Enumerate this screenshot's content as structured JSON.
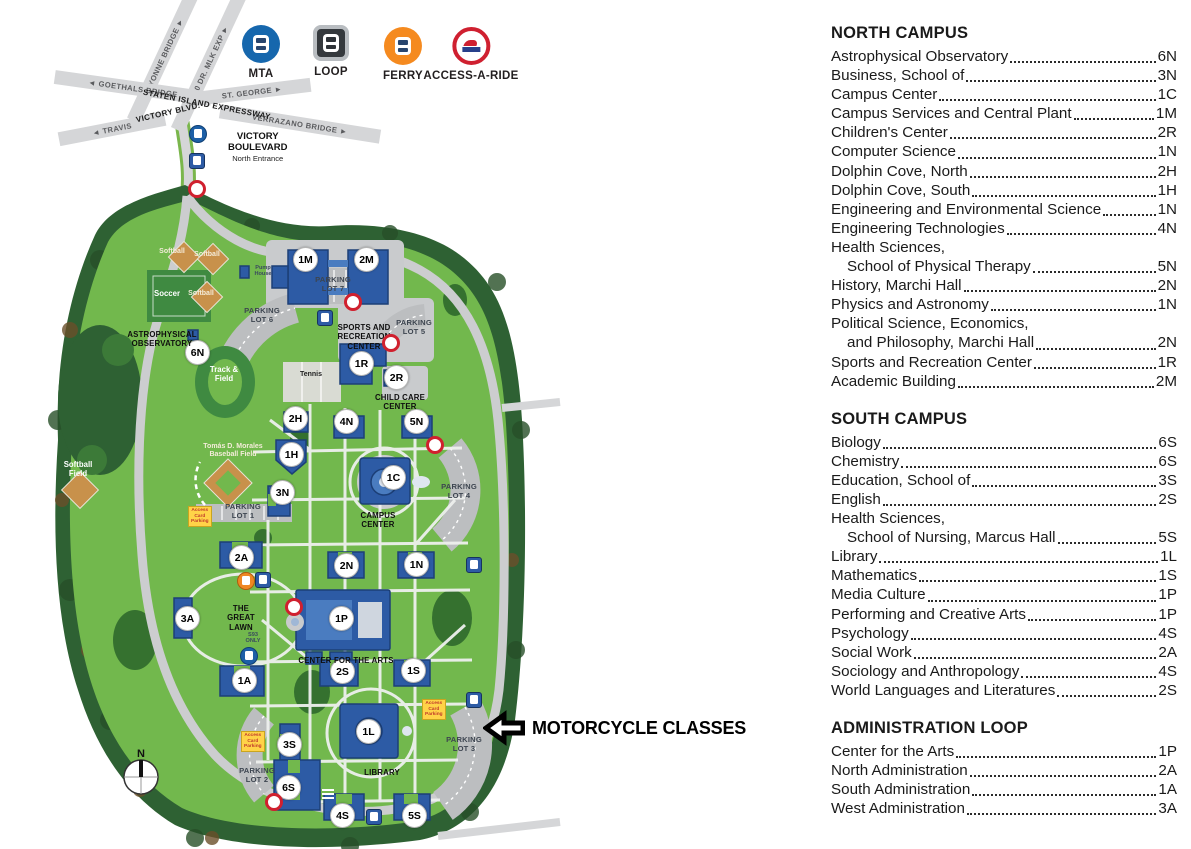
{
  "colors": {
    "campus_green": "#72b84d",
    "field_green": "#3f8a41",
    "tree_green": "#2e6133",
    "road_gray": "#d5d6d8",
    "parking_gray": "#bcbec0",
    "building_blue": "#2d5ba5",
    "building_outline": "#1c3f77",
    "marker_red": "#d0202e",
    "sign_yellow": "#ffd348",
    "mta_blue": "#1667ad",
    "loop_dark": "#35393d",
    "ferry_orange": "#f58a1f",
    "aar_red": "#cf2030"
  },
  "transit_legend": {
    "items": [
      {
        "name": "MTA",
        "type": "mta",
        "x": 261,
        "y": 25
      },
      {
        "name": "LOOP",
        "type": "loop",
        "x": 331,
        "y": 25
      },
      {
        "name": "FERRY",
        "type": "ferry",
        "x": 403,
        "y": 27
      },
      {
        "name": "ACCESS-A-RIDE",
        "type": "aar",
        "x": 471,
        "y": 27
      }
    ]
  },
  "roads": [
    {
      "label": "BAYONNE BRIDGE ►",
      "x": 163,
      "y": 57,
      "w": 140,
      "rot": -65,
      "bold": false
    },
    {
      "label": "440   DR. MLK EXP ►",
      "x": 209,
      "y": 62,
      "w": 150,
      "rot": -65,
      "bold": false
    },
    {
      "label": "◄ GOETHALS BRIDGE",
      "x": 133,
      "y": 88,
      "w": 158,
      "rot": 8,
      "bold": false
    },
    {
      "label": "ST. GEORGE ►",
      "x": 252,
      "y": 92,
      "w": 118,
      "rot": -7,
      "bold": false
    },
    {
      "label": "◄ TRAVIS",
      "x": 112,
      "y": 129,
      "w": 108,
      "rot": -11,
      "bold": false
    },
    {
      "label": "VERRAZANO BRIDGE ►",
      "x": 300,
      "y": 124,
      "w": 162,
      "rot": 9,
      "bold": false
    },
    {
      "label": "STATEN ISLAND EXPRESSWAY",
      "x": 207,
      "y": 104,
      "w": 178,
      "rot": 11,
      "bold": true
    },
    {
      "label": "VICTORY BLVD.",
      "x": 168,
      "y": 112,
      "w": 106,
      "rot": -13,
      "bold": true
    }
  ],
  "entrance": {
    "line1": "VICTORY",
    "line2": "BOULEVARD",
    "line3": "North Entrance"
  },
  "map": {
    "markers": [
      {
        "code": "6N",
        "x": 197,
        "y": 352
      },
      {
        "code": "1M",
        "x": 305,
        "y": 259
      },
      {
        "code": "2M",
        "x": 366,
        "y": 259
      },
      {
        "code": "1R",
        "x": 361,
        "y": 363
      },
      {
        "code": "2R",
        "x": 396,
        "y": 377
      },
      {
        "code": "2H",
        "x": 295,
        "y": 418
      },
      {
        "code": "4N",
        "x": 346,
        "y": 421
      },
      {
        "code": "5N",
        "x": 416,
        "y": 421
      },
      {
        "code": "1H",
        "x": 291,
        "y": 454
      },
      {
        "code": "3N",
        "x": 282,
        "y": 492
      },
      {
        "code": "1C",
        "x": 393,
        "y": 477
      },
      {
        "code": "2A",
        "x": 241,
        "y": 557
      },
      {
        "code": "2N",
        "x": 346,
        "y": 565
      },
      {
        "code": "1N",
        "x": 416,
        "y": 564
      },
      {
        "code": "3A",
        "x": 187,
        "y": 618
      },
      {
        "code": "1P",
        "x": 341,
        "y": 618
      },
      {
        "code": "1A",
        "x": 244,
        "y": 680
      },
      {
        "code": "2S",
        "x": 342,
        "y": 671
      },
      {
        "code": "1S",
        "x": 413,
        "y": 670
      },
      {
        "code": "3S",
        "x": 289,
        "y": 744
      },
      {
        "code": "6S",
        "x": 288,
        "y": 787
      },
      {
        "code": "1L",
        "x": 368,
        "y": 731
      },
      {
        "code": "4S",
        "x": 342,
        "y": 815
      },
      {
        "code": "5S",
        "x": 414,
        "y": 815
      }
    ],
    "labels": [
      {
        "text": "ASTROPHYSICAL\nOBSERVATORY",
        "x": 162,
        "y": 330,
        "cls": "lb-building"
      },
      {
        "text": "PARKING\nLOT 7",
        "x": 333,
        "y": 276,
        "cls": "lb-parking"
      },
      {
        "text": "PARKING\nLOT 6",
        "x": 262,
        "y": 307,
        "cls": "lb-parking"
      },
      {
        "text": "PARKING\nLOT 5",
        "x": 414,
        "y": 319,
        "cls": "lb-parking"
      },
      {
        "text": "PARKING\nLOT 4",
        "x": 459,
        "y": 483,
        "cls": "lb-parking"
      },
      {
        "text": "PARKING\nLOT 1",
        "x": 243,
        "y": 503,
        "cls": "lb-parking"
      },
      {
        "text": "PARKING\nLOT 2",
        "x": 257,
        "y": 767,
        "cls": "lb-parking"
      },
      {
        "text": "PARKING\nLOT 3",
        "x": 464,
        "y": 736,
        "cls": "lb-parking"
      },
      {
        "text": "SPORTS AND\nRECREATION\nCENTER",
        "x": 364,
        "y": 323,
        "cls": "lb-building"
      },
      {
        "text": "CHILD CARE\nCENTER",
        "x": 400,
        "y": 393,
        "cls": "lb-building"
      },
      {
        "text": "CAMPUS\nCENTER",
        "x": 378,
        "y": 511,
        "cls": "lb-building"
      },
      {
        "text": "CENTER FOR THE ARTS",
        "x": 346,
        "y": 656,
        "cls": "lb-building"
      },
      {
        "text": "LIBRARY",
        "x": 382,
        "y": 768,
        "cls": "lb-building"
      },
      {
        "text": "THE\nGREAT\nLAWN",
        "x": 241,
        "y": 604,
        "cls": "lb-building"
      },
      {
        "text": "Track &\nField",
        "x": 224,
        "y": 366,
        "cls": "lb-field"
      },
      {
        "text": "Tennis",
        "x": 311,
        "y": 371,
        "cls": "lb-dark-sm"
      },
      {
        "text": "Soccer",
        "x": 167,
        "y": 290,
        "cls": "lb-field"
      },
      {
        "text": "Softball",
        "x": 172,
        "y": 248,
        "cls": "lb-field-sm"
      },
      {
        "text": "Softball",
        "x": 207,
        "y": 251,
        "cls": "lb-field-sm"
      },
      {
        "text": "Softball",
        "x": 201,
        "y": 290,
        "cls": "lb-field-sm"
      },
      {
        "text": "Tomás D. Morales\nBaseball Field",
        "x": 233,
        "y": 443,
        "cls": "lb-field-sm"
      },
      {
        "text": "Softball\nField",
        "x": 78,
        "y": 461,
        "cls": "lb-field"
      },
      {
        "text": "Pump\nHouse",
        "x": 263,
        "y": 265,
        "cls": "lb-tiny"
      },
      {
        "text": "S93\nONLY",
        "x": 253,
        "y": 632,
        "cls": "lb-tiny"
      }
    ],
    "stops": [
      {
        "x": 197,
        "y": 189
      },
      {
        "x": 353,
        "y": 302
      },
      {
        "x": 391,
        "y": 343
      },
      {
        "x": 435,
        "y": 445
      },
      {
        "x": 294,
        "y": 607
      },
      {
        "x": 274,
        "y": 802
      }
    ],
    "buses": [
      {
        "type": "ci",
        "x": 197,
        "y": 133
      },
      {
        "type": "sq",
        "x": 197,
        "y": 161
      },
      {
        "type": "sq",
        "x": 325,
        "y": 318
      },
      {
        "type": "ci orange",
        "x": 245,
        "y": 580
      },
      {
        "type": "sq",
        "x": 263,
        "y": 580
      },
      {
        "type": "ci",
        "x": 248,
        "y": 655
      },
      {
        "type": "sq",
        "x": 474,
        "y": 565
      },
      {
        "type": "sq",
        "x": 474,
        "y": 700
      },
      {
        "type": "sq",
        "x": 374,
        "y": 817
      }
    ],
    "signs": [
      {
        "text": "Access\nCard\nParking",
        "x": 201,
        "y": 517
      },
      {
        "text": "Access\nCard\nParking",
        "x": 254,
        "y": 742
      },
      {
        "text": "Access\nCard\nParking",
        "x": 435,
        "y": 710
      }
    ]
  },
  "annotation": {
    "text": "MOTORCYCLE CLASSES"
  },
  "compass": {
    "label": "N"
  },
  "legend_sections": [
    {
      "title": "NORTH CAMPUS",
      "entries": [
        {
          "name": "Astrophysical Observatory",
          "code": "6N"
        },
        {
          "name": "Business, School of",
          "code": "3N"
        },
        {
          "name": "Campus Center",
          "code": "1C"
        },
        {
          "name": "Campus Services and Central Plant",
          "code": "1M"
        },
        {
          "name": "Children's Center",
          "code": "2R"
        },
        {
          "name": "Computer Science",
          "code": "1N"
        },
        {
          "name": "Dolphin Cove, North",
          "code": "2H"
        },
        {
          "name": "Dolphin Cove, South",
          "code": "1H"
        },
        {
          "name": "Engineering and Environmental Science",
          "code": "1N"
        },
        {
          "name": "Engineering Technologies",
          "code": "4N"
        },
        {
          "name": "Health Sciences,",
          "name2": "School of Physical Therapy",
          "code": "5N"
        },
        {
          "name": "History, Marchi Hall",
          "code": "2N"
        },
        {
          "name": "Physics and Astronomy",
          "code": "1N"
        },
        {
          "name": "Political Science, Economics,",
          "name2": "and Philosophy, Marchi Hall",
          "code": "2N"
        },
        {
          "name": "Sports and Recreation Center",
          "code": "1R"
        },
        {
          "name": "Academic Building",
          "code": "2M"
        }
      ]
    },
    {
      "title": "SOUTH CAMPUS",
      "entries": [
        {
          "name": "Biology",
          "code": "6S"
        },
        {
          "name": "Chemistry",
          "code": "6S"
        },
        {
          "name": "Education, School of",
          "code": "3S"
        },
        {
          "name": "English",
          "code": "2S"
        },
        {
          "name": "Health Sciences,",
          "name2": "School of Nursing, Marcus Hall",
          "code": "5S"
        },
        {
          "name": "Library",
          "code": "1L"
        },
        {
          "name": "Mathematics",
          "code": "1S"
        },
        {
          "name": "Media Culture",
          "code": "1P"
        },
        {
          "name": "Performing and Creative Arts",
          "code": "1P"
        },
        {
          "name": "Psychology",
          "code": "4S"
        },
        {
          "name": "Social Work",
          "code": "2A"
        },
        {
          "name": "Sociology and Anthropology",
          "code": "4S"
        },
        {
          "name": "World Languages and Literatures",
          "code": "2S"
        }
      ]
    },
    {
      "title": "ADMINISTRATION LOOP",
      "entries": [
        {
          "name": "Center for the Arts",
          "code": "1P"
        },
        {
          "name": "North Administration",
          "code": "2A"
        },
        {
          "name": "South Administration",
          "code": "1A"
        },
        {
          "name": "West Administration",
          "code": "3A"
        }
      ]
    }
  ]
}
